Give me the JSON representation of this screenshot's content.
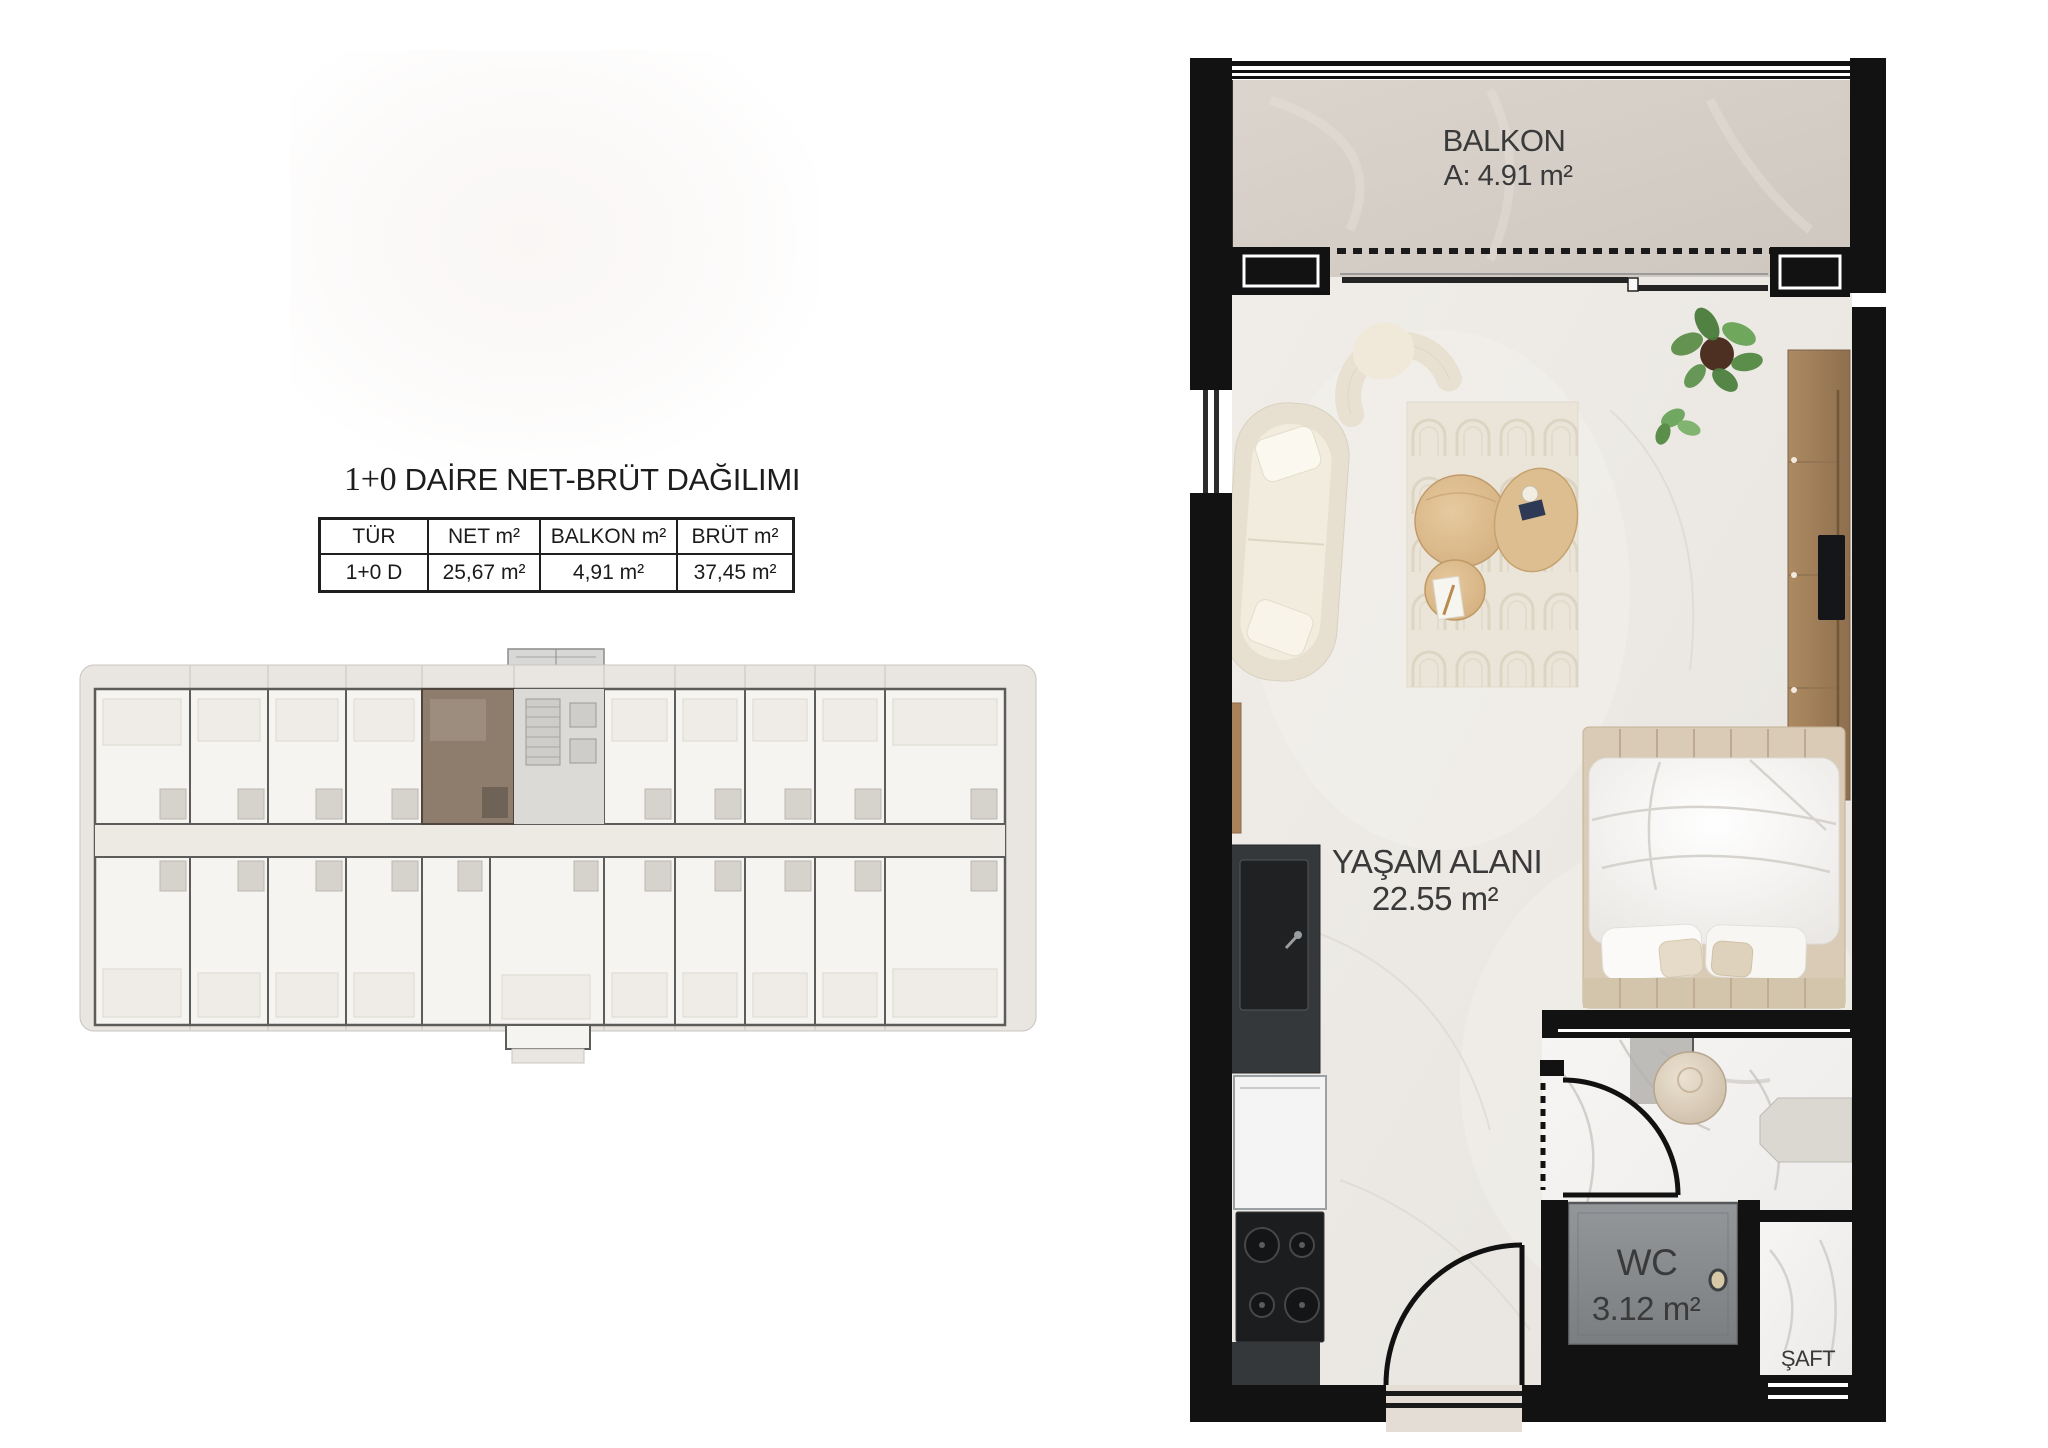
{
  "title": {
    "prefix": "1+0",
    "rest": " DAİRE NET-BRÜT DAĞILIMI",
    "full": "1+0 DAİRE NET-BRÜT DAĞILIMI"
  },
  "table": {
    "headers": [
      "TÜR",
      "NET m²",
      "BALKON m²",
      "BRÜT m²"
    ],
    "row": [
      "1+0 D",
      "25,67 m²",
      "4,91 m²",
      "37,45 m²"
    ]
  },
  "plan": {
    "balcony_label": "BALKON",
    "balcony_area": "A: 4.91 m²",
    "living_label": "YAŞAM ALANI",
    "living_area": "22.55 m²",
    "wc_label": "WC",
    "wc_area": "3.12 m²",
    "shaft_label": "ŞAFT",
    "unit_type": "1+0 D"
  },
  "colors": {
    "wall": "#121212",
    "balcony_floor": "#d6cfc7",
    "living_floor": "#edeae5",
    "bathroom_floor": "#f4f3f1",
    "wc_shower": "#8b8e91",
    "key_plan_highlight": "#8e7c6d",
    "key_plan_walls": "#5c5c5a",
    "wood": "#a8865f",
    "label_text": "#3a3a3a"
  }
}
